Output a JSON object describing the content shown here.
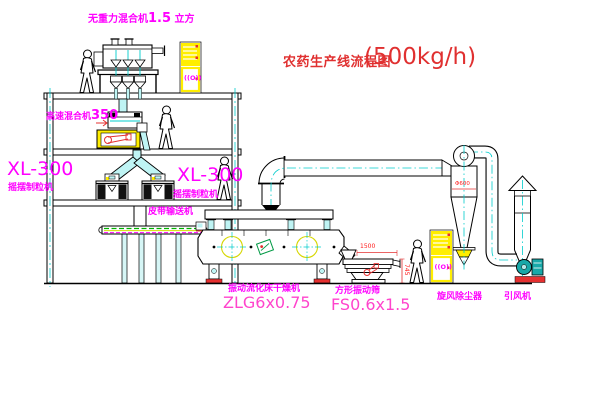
{
  "title": {
    "name": "农药生产线流程图",
    "capacity": "(500kg/h)"
  },
  "equipment_labels": {
    "gravity_mixer": {
      "name": "无重力混合机",
      "capacity": "1.5",
      "unit": "立方"
    },
    "high_speed_mixer": {
      "name": "高速混合机",
      "model": "350"
    },
    "granulator_left": {
      "model": "XL-300",
      "name": "摇摆制粒机"
    },
    "granulator_right": {
      "model": "XL-300",
      "name": "摇摆制粒机"
    },
    "belt_conveyor": {
      "name": "皮带输送机"
    },
    "fluid_bed_dryer": {
      "name": "振动流化床干燥机",
      "model": "ZLG6x0.75"
    },
    "vibrating_sieve": {
      "name": "方形振动筛",
      "model": "FS0.6x1.5"
    },
    "cyclone": {
      "name": "旋风除尘器"
    },
    "induced_draft_fan": {
      "name": "引风机"
    }
  },
  "dimensions": {
    "cyclone_diameter": "Φ600",
    "sieve_length": "1500",
    "sieve_height": "745"
  },
  "control_cabinet_symbol": "((O))",
  "colors": {
    "label_magenta": "#FF00FF",
    "model_pink": "#FF44CC",
    "title_red": "#E03030",
    "dimension_red": "#FF1A1A",
    "centerline_cyan": "#00CCCC",
    "chute_cyan_fill": "#BFF4F4",
    "cabinet_yellow": "#FFEE00",
    "conveyor_green": "#00B400",
    "fan_teal": "#18A8A8",
    "logo_green": "#009944"
  }
}
